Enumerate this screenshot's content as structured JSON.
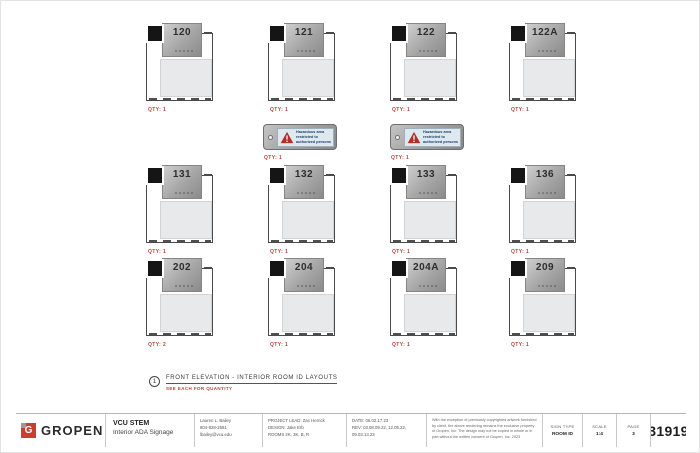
{
  "signs": [
    {
      "number": "120",
      "qty": "QTY: 1"
    },
    {
      "number": "121",
      "qty": "QTY: 1"
    },
    {
      "number": "122",
      "qty": "QTY: 1"
    },
    {
      "number": "122A",
      "qty": "QTY: 1"
    },
    {
      "number": "131",
      "qty": "QTY: 1"
    },
    {
      "number": "132",
      "qty": "QTY: 1"
    },
    {
      "number": "133",
      "qty": "QTY: 1"
    },
    {
      "number": "136",
      "qty": "QTY: 1"
    },
    {
      "number": "202",
      "qty": "QTY: 2"
    },
    {
      "number": "204",
      "qty": "QTY: 1"
    },
    {
      "number": "204A",
      "qty": "QTY: 1"
    },
    {
      "number": "209",
      "qty": "QTY: 1"
    }
  ],
  "hazard_signs": [
    {
      "line1": "Hazardous area",
      "line2": "restricted to",
      "line3": "authorized persons",
      "qty": "QTY: 1"
    },
    {
      "line1": "Hazardous area",
      "line2": "restricted to",
      "line3": "authorized persons",
      "qty": "QTY: 1"
    }
  ],
  "note": {
    "number": "1",
    "title": "FRONT ELEVATION - INTERIOR ROOM ID LAYOUTS",
    "subtitle": "SEE EACH FOR QUANTITY"
  },
  "footer": {
    "logo_text": "GROPEN",
    "logo_glyph": "G",
    "project_title": "VCU STEM",
    "project_subtitle": "Interior ADA Signage",
    "contact": {
      "line1": "Lauren L. Bailey",
      "line2": "804-828-2581",
      "line3": "lbailey@vcu.edu"
    },
    "team": {
      "line1": "PROJECT LEAD: Zac Herrick",
      "line2": "DESIGN: Jake Erb",
      "line3": "ROOMS 2K, 3K, B, R"
    },
    "dates": {
      "line1": "DATE: 06.02.17.23",
      "line2": "REV: 03.08.09.22, 12.05.22,",
      "line3": "09.03.13.23"
    },
    "disclaimer": "With the exception of previously copyrighted artwork furnished by client, the above rendering remains the exclusive property of Gropen, Inc. The design may not be copied in whole or in part without the written consent of Gropen, Inc. 2023",
    "sign_type_label": "SIGN TYPE",
    "sign_type_value": "ROOM ID",
    "scale_label": "SCALE",
    "scale_value": "1:4",
    "page_label": "PAGE",
    "page_value": "3",
    "job_number": "31919"
  },
  "colors": {
    "accent_red": "#b5443a",
    "logo_red": "#c7402e",
    "hazard_triangle": "#b03028",
    "hazard_label_bg": "#dde8ef",
    "plate_gray": "#a5a5a5",
    "insert_black": "#151515"
  }
}
